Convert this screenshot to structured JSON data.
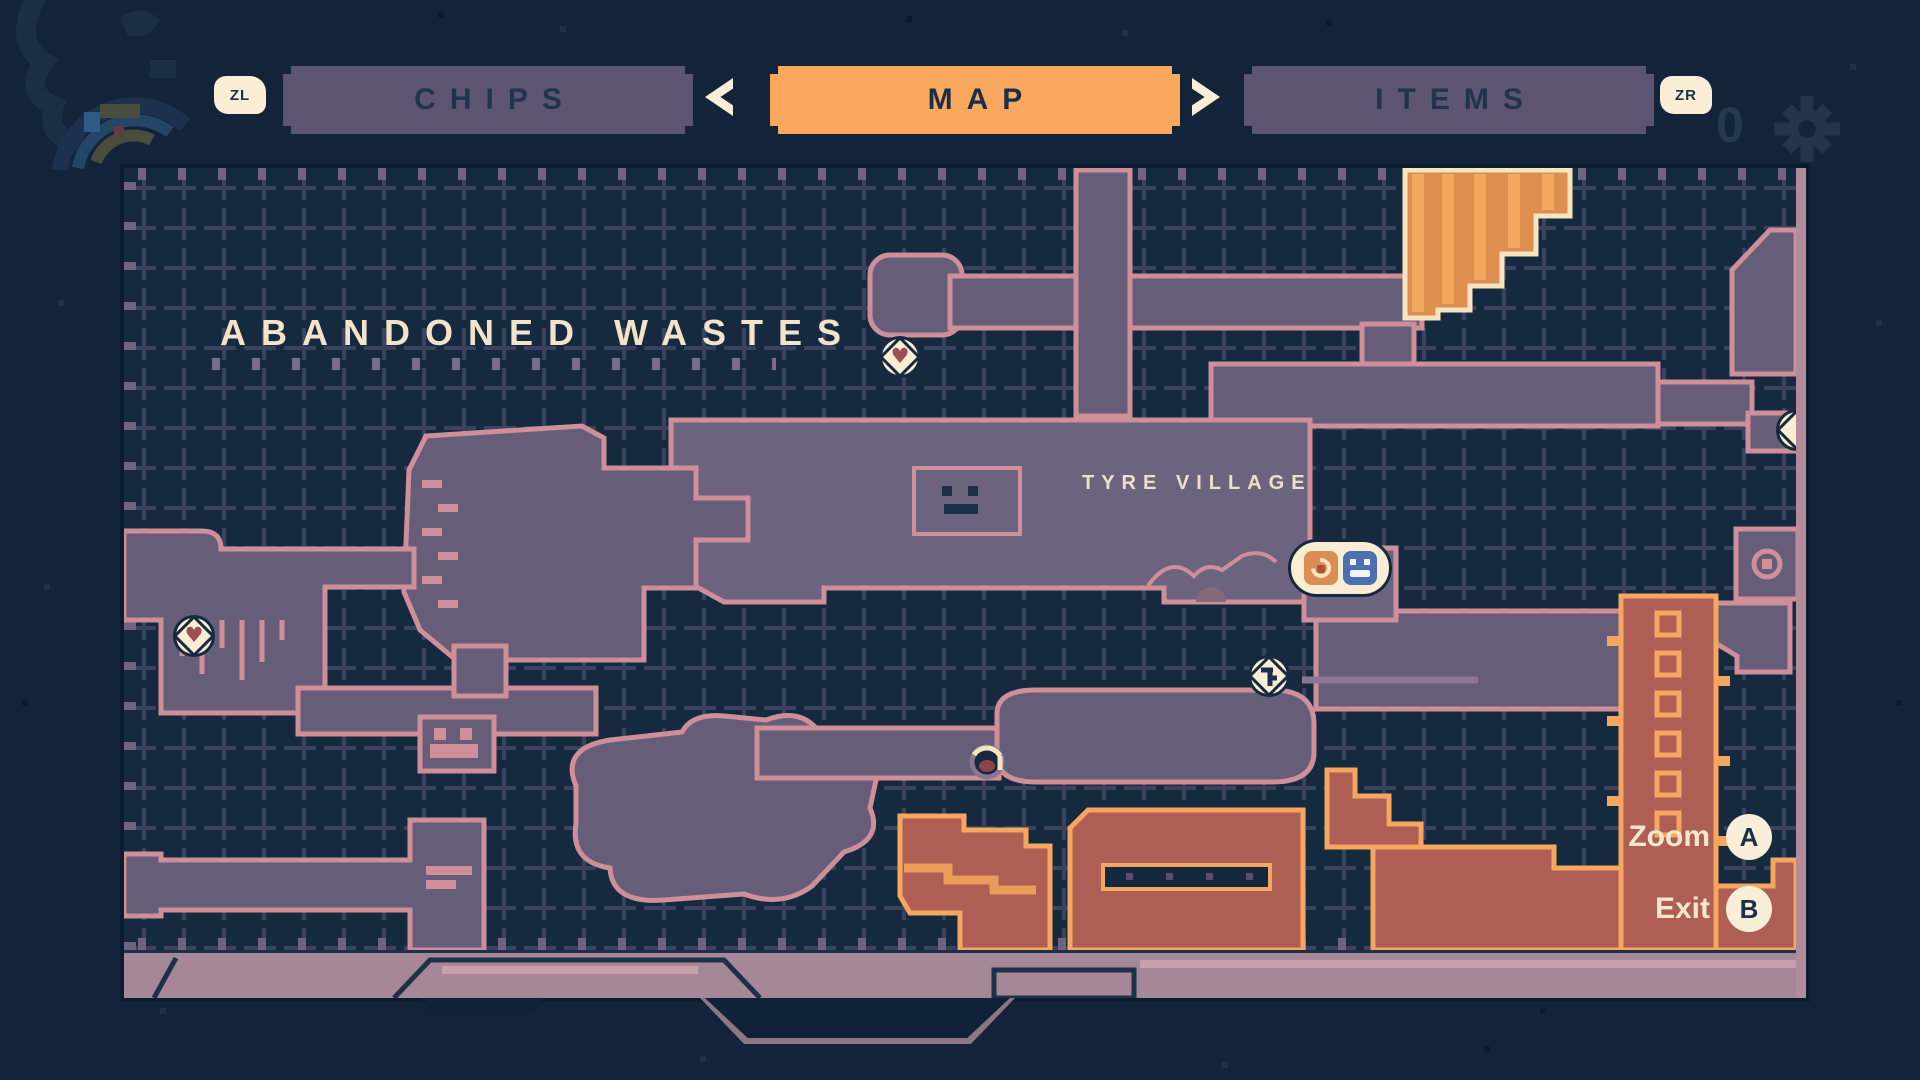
{
  "shoulder_buttons": {
    "left": "ZL",
    "right": "ZR"
  },
  "tabs": [
    {
      "label": "CHIPS",
      "active": false
    },
    {
      "label": "MAP",
      "active": true
    },
    {
      "label": "ITEMS",
      "active": false
    }
  ],
  "nav_icons": {
    "prev_tab": "left-triangle-arrow",
    "next_tab": "right-triangle-arrow"
  },
  "background_deco": {
    "coin_count": "0",
    "settings_icon": "gear"
  },
  "map": {
    "region_label": "ABANDONED WASTES",
    "area_label": "TYRE VILLAGE",
    "markers": [
      {
        "name": "health-station-top",
        "icon": "heart-badge"
      },
      {
        "name": "health-station-left",
        "icon": "heart-badge"
      },
      {
        "name": "shop",
        "icon": "orange-spiral-tile"
      },
      {
        "name": "save-station",
        "icon": "blue-terminal-tile"
      },
      {
        "name": "key-item",
        "icon": "key-badge"
      },
      {
        "name": "player-position",
        "icon": "player-dot"
      },
      {
        "name": "edge-exit-right",
        "icon": "half-badge"
      }
    ],
    "glyphs": {
      "heart": "♥"
    }
  },
  "controls": [
    {
      "label": "Zoom",
      "button": "A"
    },
    {
      "label": "Exit",
      "button": "B"
    }
  ],
  "colors": {
    "background": "#132339",
    "map_background": "#15293F",
    "grid": "#3A425F",
    "tab_inactive": "#5D5472",
    "tab_active": "#F9A85E",
    "cream": "#F9EDD3",
    "room_fill": "#665D78",
    "room_fill_light": "#6C637F",
    "room_border": "#CE8F99",
    "hot_room_fill": "#AE5E55",
    "hot_room_border": "#F5A75F",
    "stairs_fill": "#DE8F50",
    "stairs_border": "#F7E4C1",
    "frame_bar": "#A68798",
    "heart": "#9B4E57",
    "save_blue": "#4C6FB0",
    "shop_orange": "#DB8D52"
  }
}
